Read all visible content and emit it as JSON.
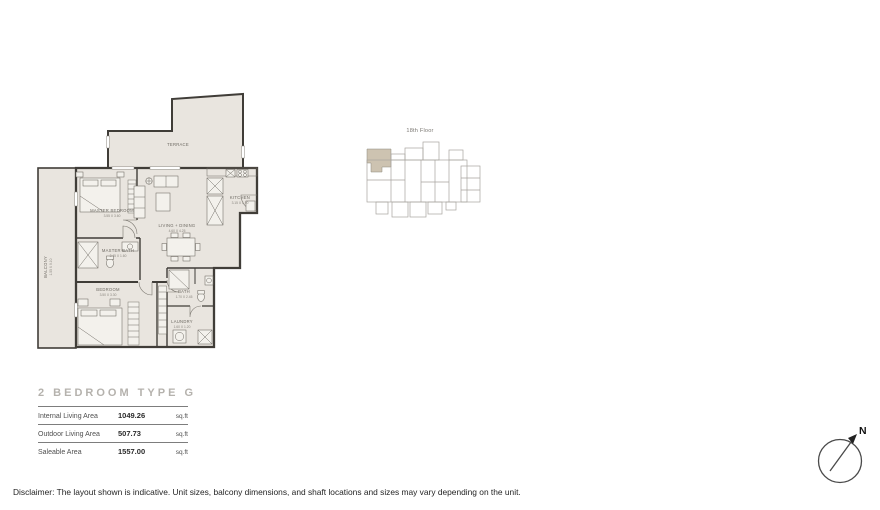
{
  "plan": {
    "rooms": {
      "terrace": {
        "label": "TERRACE"
      },
      "balcony": {
        "label": "BALCONY",
        "dims": "1.55 X 9.10"
      },
      "master_bedroom": {
        "label": "MASTER BEDROOM",
        "dims": "3.55 X 3.60"
      },
      "master_bath": {
        "label": "MASTER BATH",
        "dims": "2.45 X 1.60"
      },
      "living_dining": {
        "label": "LIVING + DINING",
        "dims": "4.60 X 4.25"
      },
      "kitchen": {
        "label": "KITCHEN",
        "dims": "3.15 X 1.90"
      },
      "bedroom": {
        "label": "BEDROOM",
        "dims": "3.50 X 3.30"
      },
      "bath": {
        "label": "BATH",
        "dims": "1.70 X 2.45"
      },
      "laundry": {
        "label": "LAUNDRY",
        "dims": "1.60 X 1.20"
      }
    }
  },
  "key_plan": {
    "floor_label": "18th Floor"
  },
  "title_block": {
    "title": "2 BEDROOM TYPE G",
    "rows": [
      {
        "label": "Internal Living Area",
        "value": "1049.26",
        "unit": "sq.ft"
      },
      {
        "label": "Outdoor Living Area",
        "value": "507.73",
        "unit": "sq.ft"
      },
      {
        "label": "Saleable Area",
        "value": "1557.00",
        "unit": "sq.ft"
      }
    ]
  },
  "compass": {
    "north_label": "N"
  },
  "disclaimer": "Disclaimer: The layout shown is indicative. Unit sizes, balcony dimensions, and shaft locations and sizes may vary depending on the unit.",
  "colors": {
    "wall": "#403d38",
    "floor_fill": "#e9e5df",
    "keyplan_highlight": "#cdc3b1",
    "keyplan_line": "#a7a49f",
    "title_gray": "#b5b2ad"
  }
}
